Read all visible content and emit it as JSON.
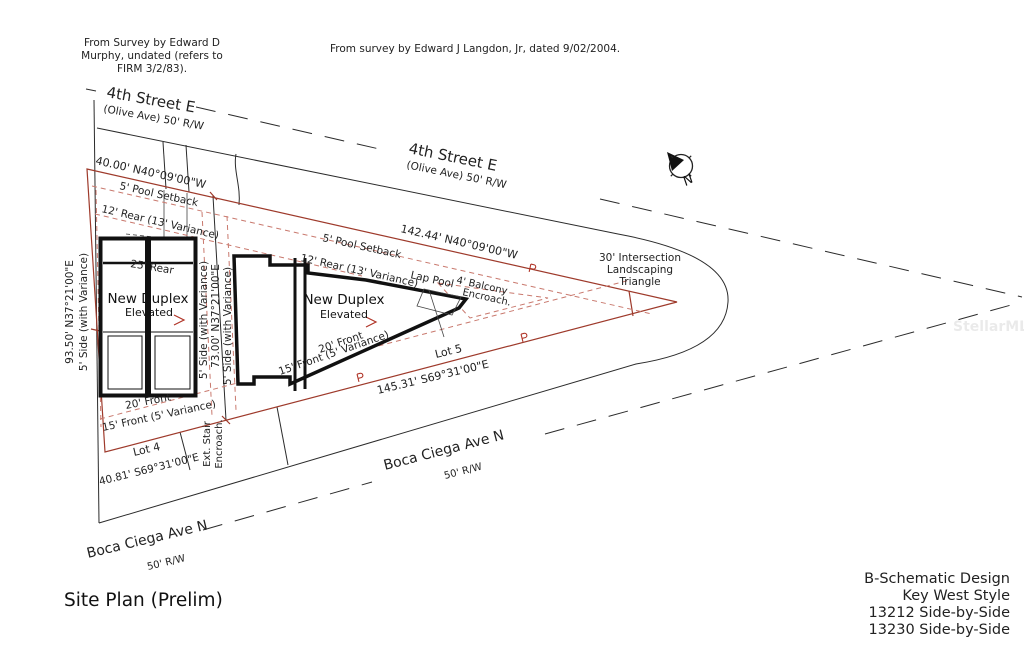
{
  "notes": {
    "s1a": "From Survey by Edward D",
    "s1b": "Murphy, undated (refers to",
    "s1c": "FIRM 3/2/83).",
    "s2": "From survey by Edward J Langdon, Jr, dated 9/02/2004."
  },
  "streets": {
    "fourth": {
      "name": "4th Street E",
      "rw": "(Olive Ave) 50' R/W"
    },
    "boca": {
      "name": "Boca Ciega Ave N",
      "rw": "50' R/W"
    }
  },
  "dimensions": {
    "d40": "40.00' N40°09'00\"W",
    "d142": "142.44' N40°09'00\"W",
    "d93": "93.50' N37°21'00\"E",
    "d73": "73.00' N37°21'00\"E",
    "d40_81": "40.81' S69°31'00\"E",
    "d145": "145.31' S69°31'00\"E"
  },
  "setbacks": {
    "pool": "5' Pool Setback",
    "rear12": "12' Rear (13' Variance)",
    "rear25": "25' Rear",
    "front20": "20' Front",
    "front15": "15' Front (5' Variance)",
    "side5": "5' Side (with Variance)"
  },
  "features": {
    "lap_pool": "Lap Pool",
    "balcony1": "4' Balcony",
    "balcony2": "Encroach.",
    "tri1": "30' Intersection",
    "tri2": "Landscaping",
    "tri3": "Triangle",
    "stair1": "Ext. Stair",
    "stair2": "Encroach.",
    "north": "N"
  },
  "lots": {
    "lot4": "Lot 4",
    "lot5": "Lot 5"
  },
  "building": {
    "line1": "New Duplex",
    "line2": "Elevated"
  },
  "title_block": {
    "title": "Site Plan (Prelim)",
    "f1": "B-Schematic Design",
    "f2": "Key West Style",
    "f3": "13212 Side-by-Side",
    "f4": "13230 Side-by-Side"
  },
  "watermark": "StellarMLS",
  "colors": {
    "boundary_red": "#9e3a2b",
    "setback_dash_red": "#c9796e",
    "line_ink": "#2b2b2b",
    "paper": "#ffffff"
  }
}
